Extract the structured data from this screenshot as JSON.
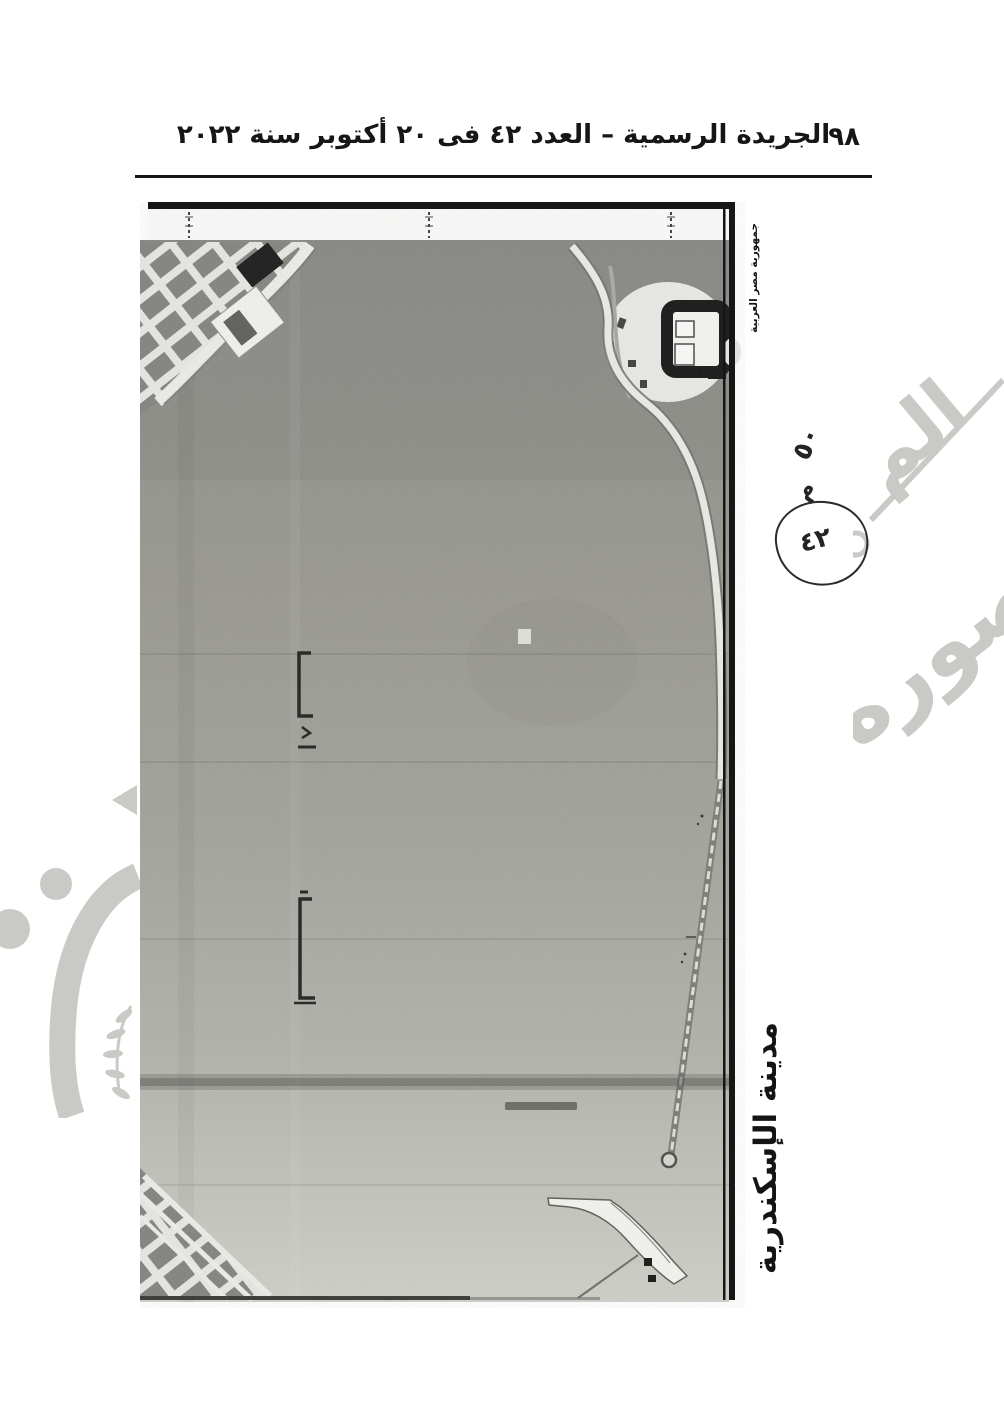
{
  "header": {
    "title": "الجريدة الرسمية – العدد ٤٢ فى ٢٠ أكتوبر سنة ٢٠٢٢",
    "page_number": "٩٨"
  },
  "map": {
    "country_label": "جمهورية مصر العربية",
    "city_label": "مدينة الإسكندرية",
    "annotation": {
      "note_value": "٥٠",
      "note_unit": "م",
      "circled_number": "٤٢"
    }
  },
  "watermark": {
    "fragment_top": "الم",
    "fragment_bottom": "صوره"
  },
  "colors": {
    "ink": "#151515",
    "scan_gray": "#9a9a94",
    "watermark_gray": "#c9c9c6"
  }
}
